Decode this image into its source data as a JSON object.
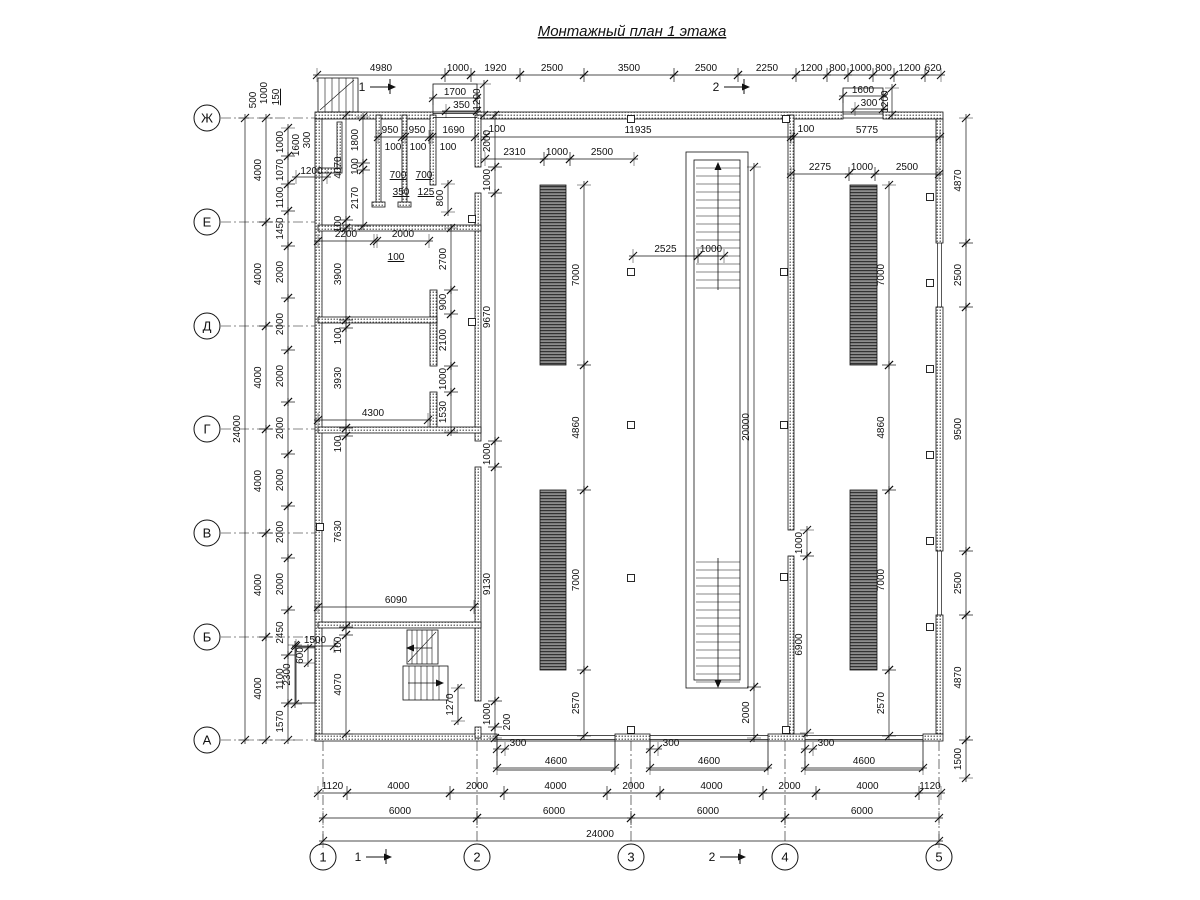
{
  "title": "Монтажный план 1 этажа",
  "axis_rows": [
    {
      "label": "Ж",
      "y": 118
    },
    {
      "label": "Е",
      "y": 222
    },
    {
      "label": "Д",
      "y": 326
    },
    {
      "label": "Г",
      "y": 429
    },
    {
      "label": "В",
      "y": 533
    },
    {
      "label": "Б",
      "y": 637
    },
    {
      "label": "А",
      "y": 740
    }
  ],
  "axis_cols": [
    {
      "label": "1",
      "x": 323
    },
    {
      "label": "2",
      "x": 477
    },
    {
      "label": "3",
      "x": 631
    },
    {
      "label": "4",
      "x": 785
    },
    {
      "label": "5",
      "x": 939
    }
  ],
  "section_marks": [
    {
      "t": "1",
      "x": 362,
      "y": 91
    },
    {
      "t": "2",
      "x": 716,
      "y": 91
    },
    {
      "t": "1",
      "x": 358,
      "y": 861
    },
    {
      "t": "2",
      "x": 712,
      "y": 861
    }
  ],
  "chains": [
    {
      "dir": "h",
      "line": 75,
      "off": -4,
      "segs": [
        {
          "t": "4980",
          "a": 317,
          "b": 445
        },
        {
          "t": "1000",
          "a": 445,
          "b": 471
        },
        {
          "t": "1920",
          "a": 471,
          "b": 520
        },
        {
          "t": "2500",
          "a": 520,
          "b": 584
        },
        {
          "t": "3500",
          "a": 584,
          "b": 674
        },
        {
          "t": "2500",
          "a": 674,
          "b": 738
        },
        {
          "t": "2250",
          "a": 738,
          "b": 796
        },
        {
          "t": "1200",
          "a": 796,
          "b": 827
        },
        {
          "t": "800",
          "a": 827,
          "b": 848
        },
        {
          "t": "1000",
          "a": 848,
          "b": 873
        },
        {
          "t": "800",
          "a": 873,
          "b": 894
        },
        {
          "t": "1200",
          "a": 894,
          "b": 925
        },
        {
          "t": "620",
          "a": 925,
          "b": 941
        }
      ]
    },
    {
      "dir": "h",
      "line": 98,
      "off": -3,
      "segs": [
        {
          "t": "1700",
          "a": 433,
          "b": 477
        }
      ]
    },
    {
      "dir": "h",
      "line": 111,
      "off": -3,
      "segs": [
        {
          "t": "350",
          "a": 446,
          "b": 477
        }
      ]
    },
    {
      "dir": "h",
      "line": 96,
      "off": -3,
      "segs": [
        {
          "t": "1600",
          "a": 843,
          "b": 883
        }
      ]
    },
    {
      "dir": "h",
      "line": 109,
      "off": -3,
      "segs": [
        {
          "t": "300",
          "a": 855,
          "b": 883
        }
      ]
    },
    {
      "dir": "h",
      "line": 137,
      "off": -4,
      "segs": [
        {
          "t": "11935",
          "a": 485,
          "b": 791
        },
        {
          "t": "5775",
          "a": 794,
          "b": 940
        }
      ]
    },
    {
      "dir": "h",
      "line": 159,
      "off": -4,
      "segs": [
        {
          "t": "2310",
          "a": 485,
          "b": 544
        },
        {
          "t": "1000",
          "a": 544,
          "b": 570
        },
        {
          "t": "2500",
          "a": 570,
          "b": 634
        }
      ]
    },
    {
      "dir": "h",
      "line": 174,
      "off": -4,
      "segs": [
        {
          "t": "2275",
          "a": 791,
          "b": 849
        },
        {
          "t": "1000",
          "a": 849,
          "b": 875
        },
        {
          "t": "2500",
          "a": 875,
          "b": 939
        }
      ]
    },
    {
      "dir": "h",
      "line": 256,
      "off": -4,
      "segs": [
        {
          "t": "2525",
          "a": 633,
          "b": 698
        },
        {
          "t": "1000",
          "a": 698,
          "b": 724
        }
      ]
    },
    {
      "dir": "h",
      "line": 137,
      "off": -4,
      "segs": [
        {
          "t": "950",
          "a": 378,
          "b": 402
        },
        {
          "t": "950",
          "a": 405,
          "b": 429
        },
        {
          "t": "1690",
          "a": 432,
          "b": 475
        }
      ]
    },
    {
      "dir": "h",
      "line": 241,
      "off": -4,
      "segs": [
        {
          "t": "2200",
          "a": 318,
          "b": 374
        },
        {
          "t": "2000",
          "a": 377,
          "b": 429
        }
      ]
    },
    {
      "dir": "h",
      "line": 420,
      "off": -4,
      "segs": [
        {
          "t": "4300",
          "a": 318,
          "b": 428
        }
      ]
    },
    {
      "dir": "h",
      "line": 607,
      "off": -4,
      "segs": [
        {
          "t": "6090",
          "a": 318,
          "b": 474
        }
      ]
    },
    {
      "dir": "h",
      "line": 177,
      "off": -3,
      "segs": [
        {
          "t": "1200",
          "a": 296,
          "b": 327
        }
      ]
    },
    {
      "dir": "h",
      "line": 646,
      "off": -3,
      "segs": [
        {
          "t": "1500",
          "a": 296,
          "b": 334
        }
      ]
    },
    {
      "dir": "h",
      "line": 768,
      "off": -4,
      "segs": [
        {
          "t": "4600",
          "a": 497,
          "b": 615
        },
        {
          "t": "4600",
          "a": 650,
          "b": 768
        },
        {
          "t": "4600",
          "a": 805,
          "b": 923
        }
      ]
    },
    {
      "dir": "h",
      "line": 793,
      "off": -4,
      "segs": [
        {
          "t": "1120",
          "a": 318,
          "b": 347
        },
        {
          "t": "4000",
          "a": 347,
          "b": 450
        },
        {
          "t": "2000",
          "a": 450,
          "b": 504
        },
        {
          "t": "4000",
          "a": 504,
          "b": 607
        },
        {
          "t": "2000",
          "a": 607,
          "b": 660
        },
        {
          "t": "4000",
          "a": 660,
          "b": 763
        },
        {
          "t": "2000",
          "a": 763,
          "b": 816
        },
        {
          "t": "4000",
          "a": 816,
          "b": 919
        },
        {
          "t": "1120",
          "a": 919,
          "b": 941
        }
      ]
    },
    {
      "dir": "h",
      "line": 818,
      "off": -4,
      "segs": [
        {
          "t": "6000",
          "a": 323,
          "b": 477
        },
        {
          "t": "6000",
          "a": 477,
          "b": 631
        },
        {
          "t": "6000",
          "a": 631,
          "b": 785
        },
        {
          "t": "6000",
          "a": 785,
          "b": 939
        }
      ]
    },
    {
      "dir": "h",
      "line": 841,
      "off": -4,
      "segs": [
        {
          "t": "24000",
          "a": 323,
          "b": 939,
          "lx": 600
        }
      ]
    },
    {
      "dir": "h",
      "line": 749,
      "off": -3,
      "segs": [
        {
          "t": "300",
          "a": 497,
          "b": 505,
          "lx": 518
        },
        {
          "t": "300",
          "a": 650,
          "b": 658,
          "lx": 671
        },
        {
          "t": "300",
          "a": 805,
          "b": 813,
          "lx": 826
        }
      ]
    },
    {
      "dir": "v",
      "line": 245,
      "off": -5,
      "segs": [
        {
          "t": "24000",
          "a": 118,
          "b": 740
        }
      ]
    },
    {
      "dir": "v",
      "line": 266,
      "off": -5,
      "segs": [
        {
          "t": "4000",
          "a": 118,
          "b": 222
        },
        {
          "t": "4000",
          "a": 222,
          "b": 326
        },
        {
          "t": "4000",
          "a": 326,
          "b": 429
        },
        {
          "t": "4000",
          "a": 429,
          "b": 533
        },
        {
          "t": "4000",
          "a": 533,
          "b": 637
        },
        {
          "t": "4000",
          "a": 637,
          "b": 740
        }
      ]
    },
    {
      "dir": "v",
      "line": 288,
      "off": -5,
      "segs": [
        {
          "t": "1000",
          "a": 128,
          "b": 156
        },
        {
          "t": "1070",
          "a": 156,
          "b": 184
        },
        {
          "t": "1100",
          "a": 184,
          "b": 211
        },
        {
          "t": "1450",
          "a": 211,
          "b": 246
        },
        {
          "t": "2000",
          "a": 246,
          "b": 298
        },
        {
          "t": "2000",
          "a": 298,
          "b": 350
        },
        {
          "t": "2000",
          "a": 350,
          "b": 402
        },
        {
          "t": "2000",
          "a": 402,
          "b": 454
        },
        {
          "t": "2000",
          "a": 454,
          "b": 506
        },
        {
          "t": "2000",
          "a": 506,
          "b": 558
        },
        {
          "t": "2000",
          "a": 558,
          "b": 610
        },
        {
          "t": "2450",
          "a": 610,
          "b": 655
        },
        {
          "t": "1100",
          "a": 655,
          "b": 703
        },
        {
          "t": "1570",
          "a": 703,
          "b": 740
        }
      ]
    },
    {
      "dir": "v",
      "line": 966,
      "off": -5,
      "segs": [
        {
          "t": "4870",
          "a": 118,
          "b": 243
        },
        {
          "t": "2500",
          "a": 243,
          "b": 307
        },
        {
          "t": "9500",
          "a": 307,
          "b": 551
        },
        {
          "t": "2500",
          "a": 551,
          "b": 615
        },
        {
          "t": "4870",
          "a": 615,
          "b": 740
        },
        {
          "t": "1500",
          "a": 740,
          "b": 778
        }
      ]
    },
    {
      "dir": "v",
      "line": 346,
      "off": -5,
      "segs": [
        {
          "t": "4070",
          "a": 115,
          "b": 220
        },
        {
          "t": "100",
          "a": 220,
          "b": 228
        },
        {
          "t": "3900",
          "a": 228,
          "b": 320
        },
        {
          "t": "100",
          "a": 320,
          "b": 328,
          "ly": 336
        },
        {
          "t": "3930",
          "a": 328,
          "b": 428
        },
        {
          "t": "100",
          "a": 428,
          "b": 436,
          "ly": 444
        },
        {
          "t": "7630",
          "a": 436,
          "b": 627
        },
        {
          "t": "100",
          "a": 627,
          "b": 635,
          "ly": 645
        },
        {
          "t": "4070",
          "a": 635,
          "b": 734
        }
      ]
    },
    {
      "dir": "v",
      "line": 363,
      "off": -5,
      "segs": [
        {
          "t": "1800",
          "a": 117,
          "b": 163
        },
        {
          "t": "100",
          "a": 163,
          "b": 170
        },
        {
          "t": "2170",
          "a": 170,
          "b": 226
        }
      ]
    },
    {
      "dir": "v",
      "line": 448,
      "off": -5,
      "segs": [
        {
          "t": "800",
          "a": 184,
          "b": 212
        }
      ]
    },
    {
      "dir": "v",
      "line": 451,
      "off": -5,
      "segs": [
        {
          "t": "2700",
          "a": 228,
          "b": 290
        },
        {
          "t": "900",
          "a": 290,
          "b": 314
        },
        {
          "t": "2100",
          "a": 314,
          "b": 366
        },
        {
          "t": "1000",
          "a": 366,
          "b": 392
        },
        {
          "t": "1530",
          "a": 392,
          "b": 432
        }
      ]
    },
    {
      "dir": "v",
      "line": 495,
      "off": -5,
      "segs": [
        {
          "t": "2000",
          "a": 115,
          "b": 167
        },
        {
          "t": "1000",
          "a": 167,
          "b": 193
        },
        {
          "t": "9670",
          "a": 193,
          "b": 441
        },
        {
          "t": "1000",
          "a": 441,
          "b": 467
        },
        {
          "t": "9130",
          "a": 467,
          "b": 701
        },
        {
          "t": "1000",
          "a": 701,
          "b": 727
        },
        {
          "t": "200",
          "a": 727,
          "b": 738,
          "lx": 510,
          "ly": 722
        }
      ]
    },
    {
      "dir": "v",
      "line": 458,
      "off": -5,
      "segs": [
        {
          "t": "1270",
          "a": 688,
          "b": 721
        }
      ]
    },
    {
      "dir": "v",
      "line": 584,
      "off": -5,
      "segs": [
        {
          "t": "7000",
          "a": 185,
          "b": 365
        },
        {
          "t": "4860",
          "a": 365,
          "b": 490
        },
        {
          "t": "7000",
          "a": 490,
          "b": 670
        },
        {
          "t": "2570",
          "a": 670,
          "b": 736
        }
      ]
    },
    {
      "dir": "v",
      "line": 889,
      "off": -5,
      "segs": [
        {
          "t": "7000",
          "a": 185,
          "b": 365
        },
        {
          "t": "4860",
          "a": 365,
          "b": 490
        },
        {
          "t": "7000",
          "a": 490,
          "b": 670
        },
        {
          "t": "2570",
          "a": 670,
          "b": 736
        }
      ]
    },
    {
      "dir": "v",
      "line": 754,
      "off": -5,
      "segs": [
        {
          "t": "20000",
          "a": 167,
          "b": 687
        },
        {
          "t": "2000",
          "a": 687,
          "b": 738
        }
      ]
    },
    {
      "dir": "v",
      "line": 807,
      "off": -5,
      "segs": [
        {
          "t": "1000",
          "a": 530,
          "b": 556
        },
        {
          "t": "6900",
          "a": 556,
          "b": 733
        }
      ]
    },
    {
      "dir": "v",
      "line": 308,
      "off": -5,
      "segs": [
        {
          "t": "600",
          "a": 648,
          "b": 663
        }
      ]
    },
    {
      "dir": "v",
      "line": 295,
      "off": -5,
      "segs": [
        {
          "t": "2300",
          "a": 645,
          "b": 704
        }
      ]
    },
    {
      "dir": "v",
      "line": 484,
      "off": -4,
      "segs": [
        {
          "t": "1200",
          "a": 84,
          "b": 115
        }
      ]
    },
    {
      "dir": "v",
      "line": 892,
      "off": -4,
      "segs": [
        {
          "t": "1200",
          "a": 88,
          "b": 115
        }
      ]
    }
  ],
  "labels": [
    {
      "t": "100",
      "x": 396,
      "y": 260,
      "ul": true
    },
    {
      "t": "700",
      "x": 398,
      "y": 178,
      "ul": true
    },
    {
      "t": "700",
      "x": 424,
      "y": 178,
      "ul": true
    },
    {
      "t": "350",
      "x": 401,
      "y": 195,
      "ul": true
    },
    {
      "t": "125",
      "x": 426,
      "y": 195,
      "ul": true
    },
    {
      "t": "100",
      "x": 393,
      "y": 150
    },
    {
      "t": "100",
      "x": 418,
      "y": 150
    },
    {
      "t": "100",
      "x": 448,
      "y": 150
    },
    {
      "t": "1600",
      "x": 299,
      "y": 145,
      "rot": 90
    },
    {
      "t": "300",
      "x": 310,
      "y": 140,
      "rot": 90
    },
    {
      "t": "100",
      "x": 497,
      "y": 132
    },
    {
      "t": "100",
      "x": 806,
      "y": 132
    },
    {
      "t": "500",
      "x": 256,
      "y": 100,
      "rot": 90
    },
    {
      "t": "1000",
      "x": 267,
      "y": 93,
      "rot": 90
    },
    {
      "t": "150",
      "x": 279,
      "y": 97,
      "rot": 90,
      "ul": true
    }
  ],
  "colors": {
    "line": "#111111",
    "strip_dark": "#333333",
    "strip_base": "#8c8c8c"
  }
}
